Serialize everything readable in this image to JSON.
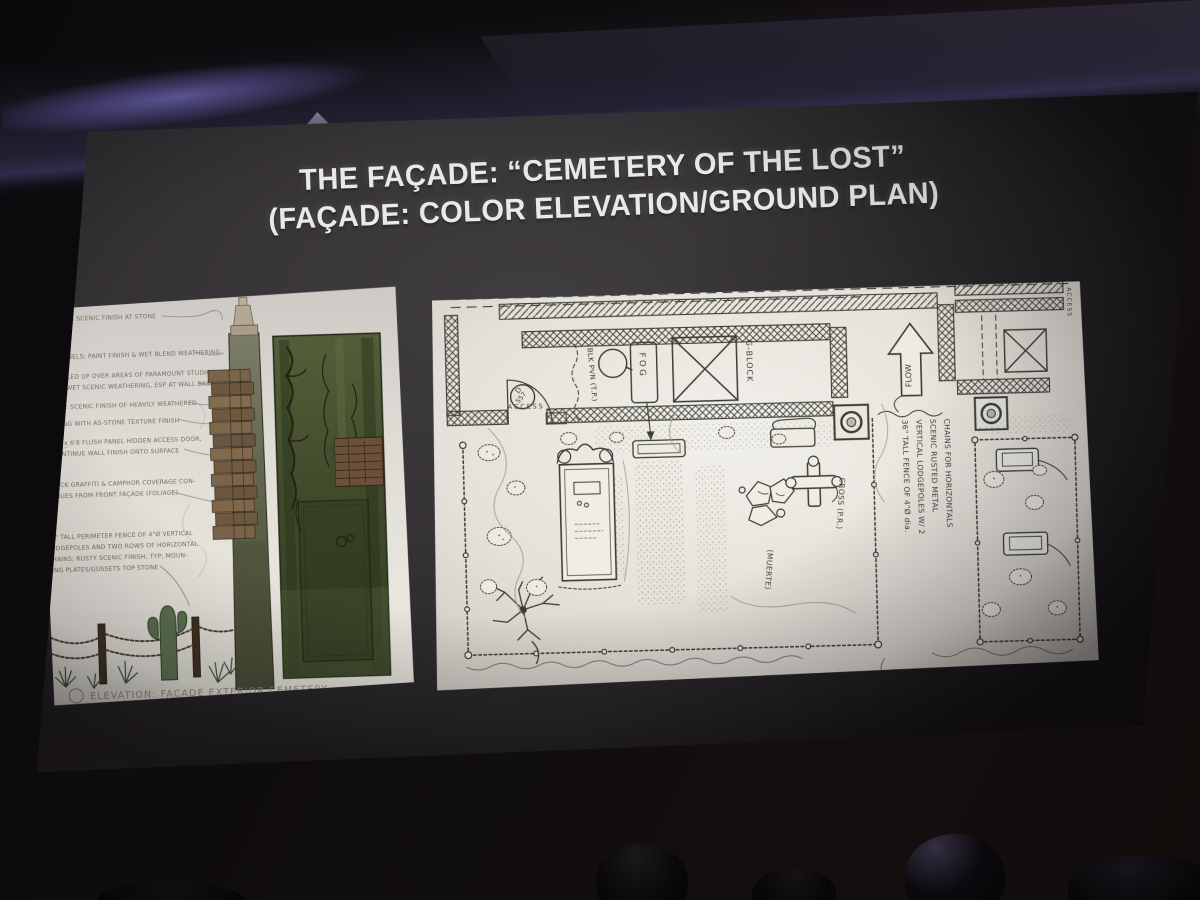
{
  "slide": {
    "title_line1": "THE FAÇADE: “CEMETERY OF THE LOST”",
    "title_line2": "(FAÇADE: COLOR ELEVATION/GROUND PLAN)"
  },
  "elevation_panel": {
    "caption": "ELEVATION: FAÇADE EXTERIOR CEMETERY",
    "annotation_lines": [
      "TEXTURE & SCENIC FINISH AT STONE",
      "FOAM PANELS; PAINT FINISH & WET BLEND WEATHERING",
      "TROWELLED UP OVER AREAS OF PARAMOUNT STUDIO",
      "STONE; WET SCENIC WEATHERING, ESP AT WALL BASE",
      "FAÇADE: SCENIC FINISH OF HEAVILY WEATHERED",
      "BUILDING WITH AS-STONE TEXTURE FINISH",
      "3'0 x 6'8 FLUSH PANEL HIDDEN ACCESS DOOR,",
      "CONTINUE WALL FINISH ONTO SURFACE",
      "BRICK GRAFFITI & CAMPHOR COVERAGE CON-",
      "TINUES FROM FRONT FAÇADE (FOLIAGE)",
      "36\" TALL PERIMETER FENCE OF 4\"Ø VERTICAL",
      "LODGEPOLES AND TWO ROWS OF HORIZONTAL",
      "CHAINS; RUSTY SCENIC FINISH, TYP; MOUN-",
      "TING PLATES/GUSSETS TOP STONE"
    ]
  },
  "plan_panel": {
    "door_tag_letter": "D",
    "door_tag_number": "557",
    "access_left": "ACCESS",
    "access_right": "ACCESS",
    "blk_pvn": "BLK PVN (T.P.)",
    "fog": "FOG",
    "g_block": "G-BLOCK",
    "flow": "FLOW",
    "cross": "CROSS (P.R.)",
    "muerte": "(MUERTE)",
    "fence_note_lines": [
      "36\" TALL FENCE OF 4\"Ø dia.",
      "VERTICAL LODGEPOLES W/ 2",
      "SCENIC RUSTED METAL",
      "CHAINS FOR HORIZONTALS"
    ]
  },
  "colors": {
    "glow_purple": "#6c64b4",
    "slide_bg": "#343134",
    "paper": "#e8e5df",
    "plan_ink": "#3c3d35",
    "title_text": "#ebe9e5",
    "wall_green": "#46502f",
    "tile_brown": "#7c654a"
  }
}
